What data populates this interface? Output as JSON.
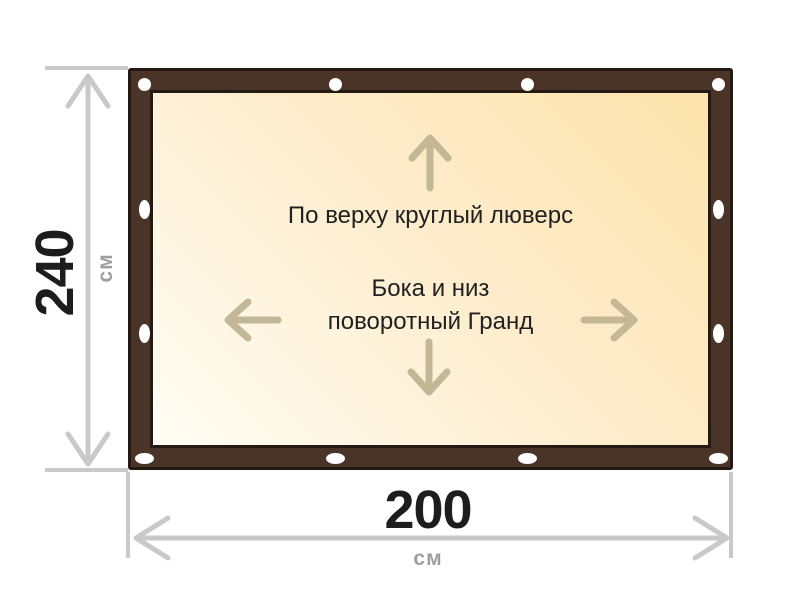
{
  "canvas": {
    "top_note": "По верху круглый люверс",
    "side_note_line1": "Бока и низ",
    "side_note_line2": "поворотный Гранд"
  },
  "dimensions": {
    "height_value": "240",
    "height_unit": "см",
    "width_value": "200",
    "width_unit": "см"
  },
  "grommets": {
    "top_type": "round",
    "sides_bottom_type": "oval",
    "top_count": 4,
    "bottom_count": 4,
    "left_count": 2,
    "right_count": 2
  },
  "colors": {
    "frame_brown": "#4a3428",
    "frame_outline": "#241a13",
    "canvas_light": "#fffdf4",
    "canvas_dark": "#fde4ad",
    "inner_arrow_tan": "#c4b795",
    "dimension_gray": "#c9c9c9",
    "unit_gray": "#9e9e9e",
    "text_dark": "#212121"
  }
}
